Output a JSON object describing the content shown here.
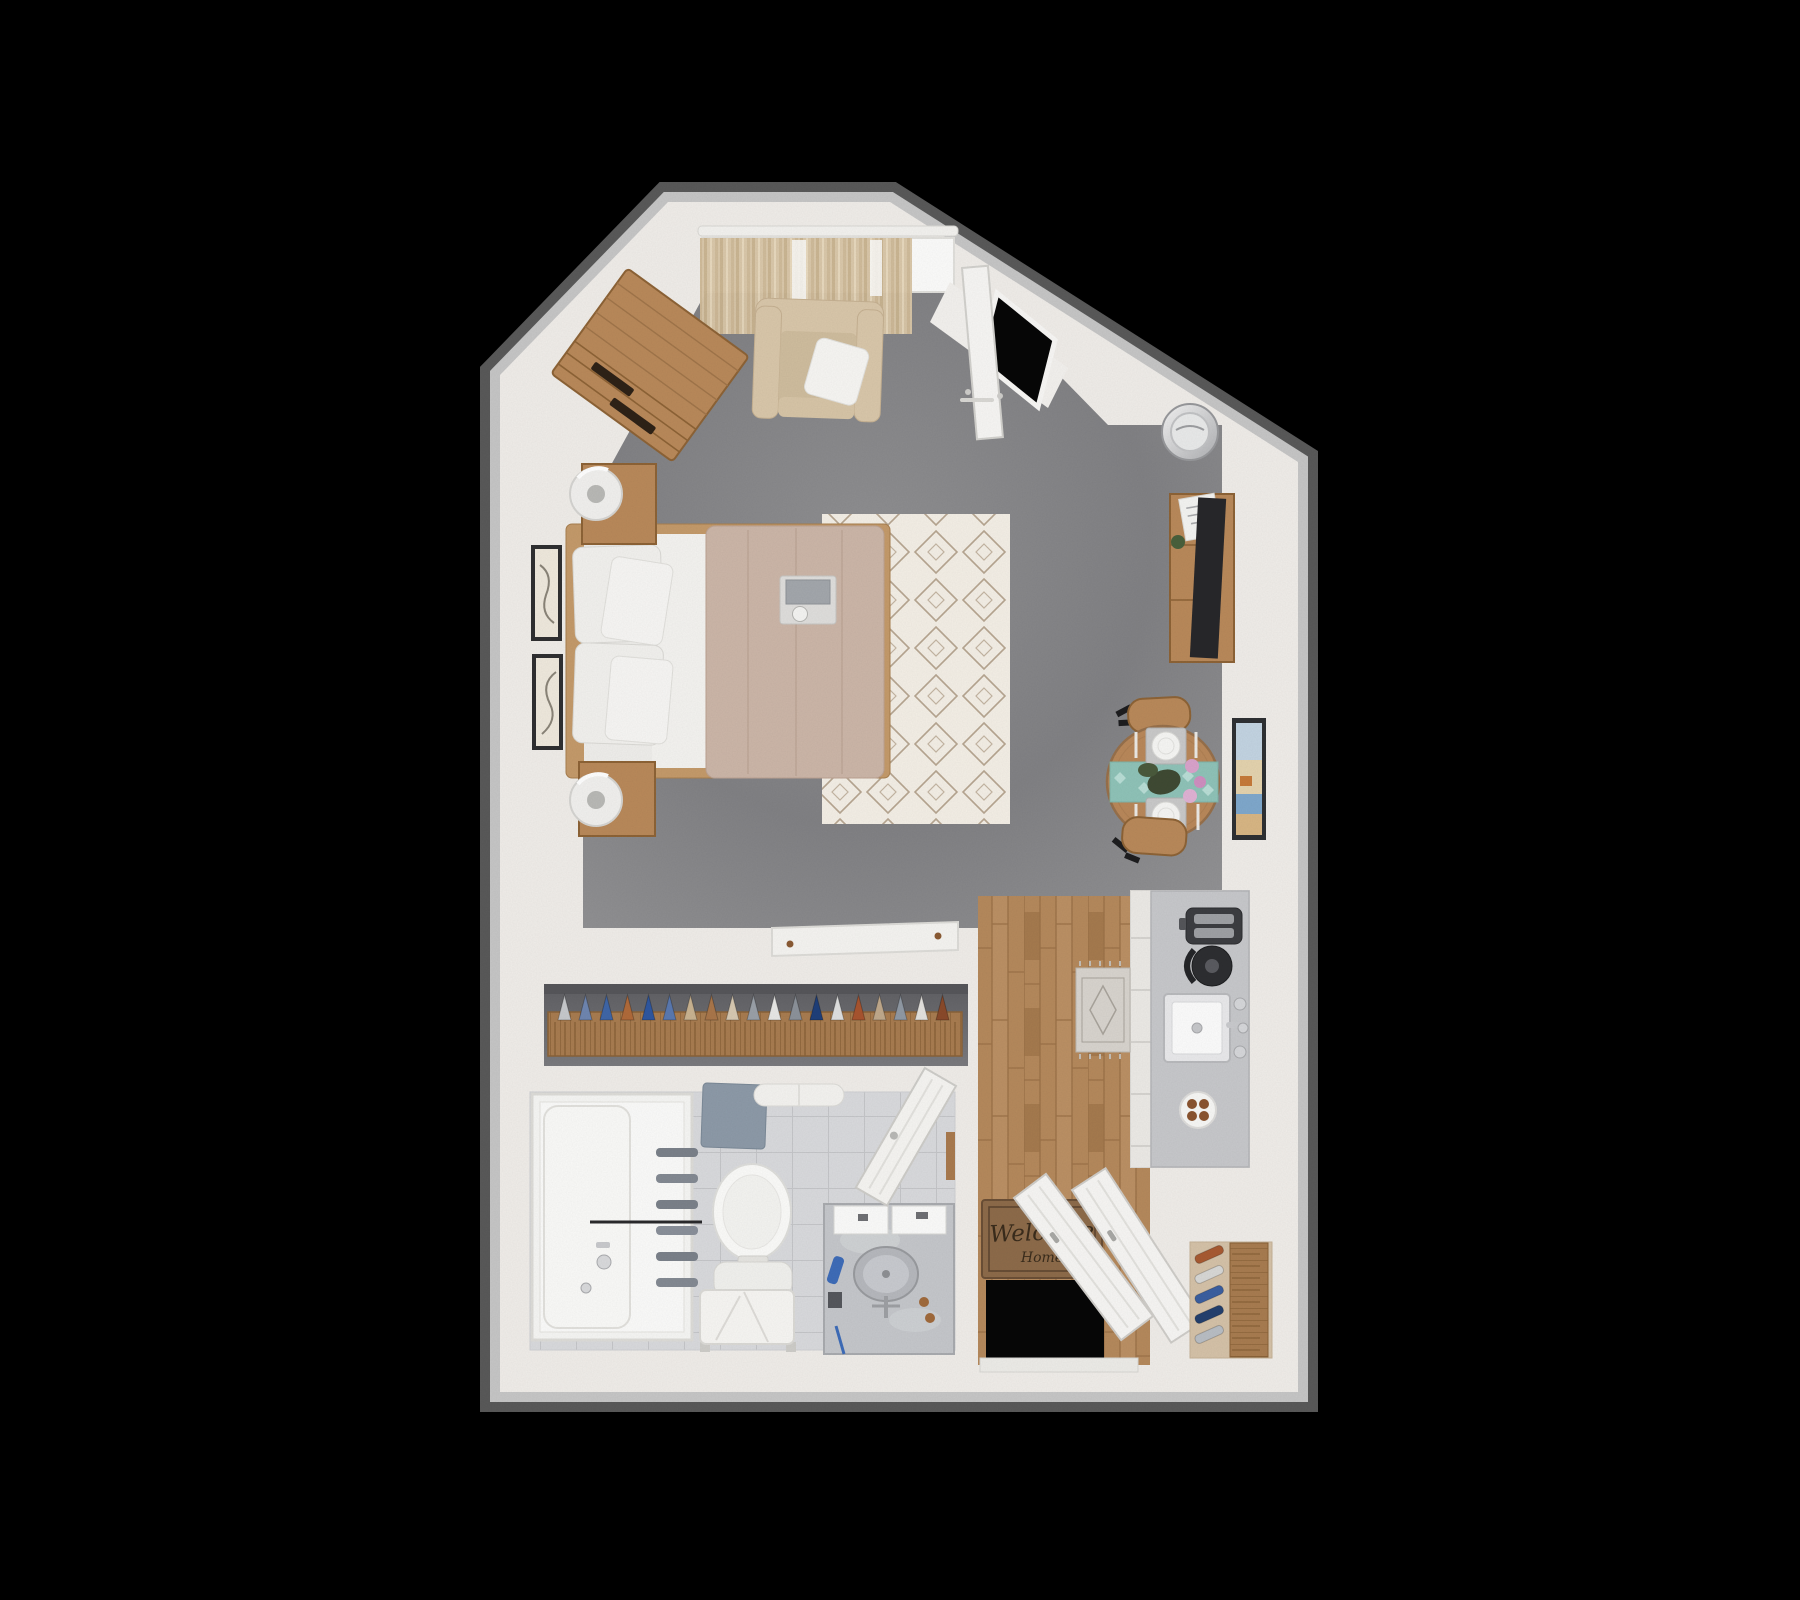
{
  "scene": {
    "kind": "3d-floor-plan-top-view",
    "description": "Rendered top-down 3D floor plan of a studio apartment on a black background: bedroom/living area with bed, armchair, dresser, TV console and round dining table; closet with hanging clothes; bathroom with shower, toilet and vanity; kitchen counter and entry hall with welcome mat, double entry doors and shoe nook."
  },
  "palette": {
    "bg": "#000000",
    "wall": "#f0ede9",
    "wall_shadow": "#c6c6c6",
    "carpet_mid": "#86868a",
    "wood_floor": "#b5895c",
    "wood_floor_line": "#9c7248",
    "wood_furn": "#b9895a",
    "wood_furn_dark": "#8d6336",
    "tile": "#d9dadd",
    "tile_line": "#c5c6c9",
    "rug": "#f4efe6",
    "rug_line": "#b7a691",
    "duvet": "#ccb6a8",
    "linen": "#f4f3f0",
    "curtain": "#d8c4a4",
    "counter": "#c7c8cb",
    "counter_white": "#f2f0ed",
    "teal": "#8fc3b8",
    "mat": "#8d6b4a",
    "mat_text": "#3a2c1c",
    "closet": "#6e6e72",
    "appliance": "#3c3d41",
    "black_opening": "#060606"
  },
  "rooms": [
    {
      "name": "bedroom-living-area",
      "floor": "gray carpet"
    },
    {
      "name": "closet",
      "floor": "dark recess with wood hanging rod"
    },
    {
      "name": "bathroom",
      "floor": "light gray tile"
    },
    {
      "name": "kitchen-entry-hall",
      "floor": "oak plank wood"
    },
    {
      "name": "shoe-nook",
      "floor": "wood shelf alcove"
    }
  ],
  "furniture": [
    {
      "id": "dresser",
      "label": "Wood dresser (angled in top-left corner)"
    },
    {
      "id": "armchair",
      "label": "Beige armchair with white throw pillow"
    },
    {
      "id": "curtains",
      "label": "Beige curtains over window on top wall"
    },
    {
      "id": "balcony-door",
      "label": "Open white door in angled top-right wall"
    },
    {
      "id": "ceiling-light",
      "label": "Round chrome ceiling light"
    },
    {
      "id": "bed",
      "label": "Bed with white linens, four pillows and taupe duvet"
    },
    {
      "id": "breakfast-tray",
      "label": "Tray with magazine and mug on duvet"
    },
    {
      "id": "nightstand-top",
      "label": "Nightstand with round lamp (above bed)"
    },
    {
      "id": "nightstand-bottom",
      "label": "Nightstand with round lamp (below bed)"
    },
    {
      "id": "wall-art",
      "label": "Two framed abstract prints on left wall"
    },
    {
      "id": "area-rug",
      "label": "Cream Berber diamond-pattern area rug"
    },
    {
      "id": "tv-console",
      "label": "Wood media console with flat TV"
    },
    {
      "id": "dining-table",
      "label": "Round wood dining table with teal runner, two place settings and flowers"
    },
    {
      "id": "dining-chairs",
      "label": "Two wood dining chairs"
    },
    {
      "id": "right-wall-art",
      "label": "Framed coastal artwork on right wall"
    },
    {
      "id": "kitchen-counter",
      "label": "Kitchen counter with toaster, kettle and sink"
    },
    {
      "id": "cookie-plate",
      "label": "Plate of cookies on counter"
    },
    {
      "id": "hall-runner",
      "label": "Small gray runner rug on wood floor"
    },
    {
      "id": "closet-rod",
      "label": "Closet rod with hanging clothes"
    },
    {
      "id": "folding-table",
      "label": "White folding table against closet wall"
    },
    {
      "id": "shower",
      "label": "Glass-enclosed shower/tub with grab bar"
    },
    {
      "id": "towel-radiator",
      "label": "Gray towel bars beside shower"
    },
    {
      "id": "toilet",
      "label": "Toilet with bench stool"
    },
    {
      "id": "vanity",
      "label": "Marble vanity with basin and toiletries"
    },
    {
      "id": "bathroom-door",
      "label": "White bathroom door, ajar"
    },
    {
      "id": "welcome-mat",
      "label": "Brown script welcome mat"
    },
    {
      "id": "entry-doors",
      "label": "Double white entry doors opened inward"
    },
    {
      "id": "shoe-rack",
      "label": "Shoe nook with wood shelf and shoes"
    }
  ],
  "closet": {
    "hanger_colors": [
      "#c7c9cc",
      "#6f86b0",
      "#3f66a8",
      "#b06a3a",
      "#2f57a0",
      "#5a79b0",
      "#c9b391",
      "#a9764a",
      "#d7c9b2",
      "#9aa0a8",
      "#e8e8e6",
      "#8c929a",
      "#1f3f7a",
      "#dfe0e0",
      "#a8542f",
      "#c0a98c",
      "#9099a4",
      "#e4e2de",
      "#8a4a2a"
    ]
  },
  "entry": {
    "mat_line1": "Welcome",
    "mat_line2": "Home",
    "shoe_colors": [
      "#a85a32",
      "#d8d8d6",
      "#3b5fa0",
      "#24406e",
      "#b9bec4"
    ]
  },
  "kitchen": {
    "counter_items": [
      "toaster",
      "kettle",
      "sink",
      "cookie-plate"
    ],
    "cookie_count": 4
  },
  "dining": {
    "seats": 2,
    "plates": 2,
    "runner_color": "#8fc3b8",
    "flower_color": "#d9a3cb"
  }
}
